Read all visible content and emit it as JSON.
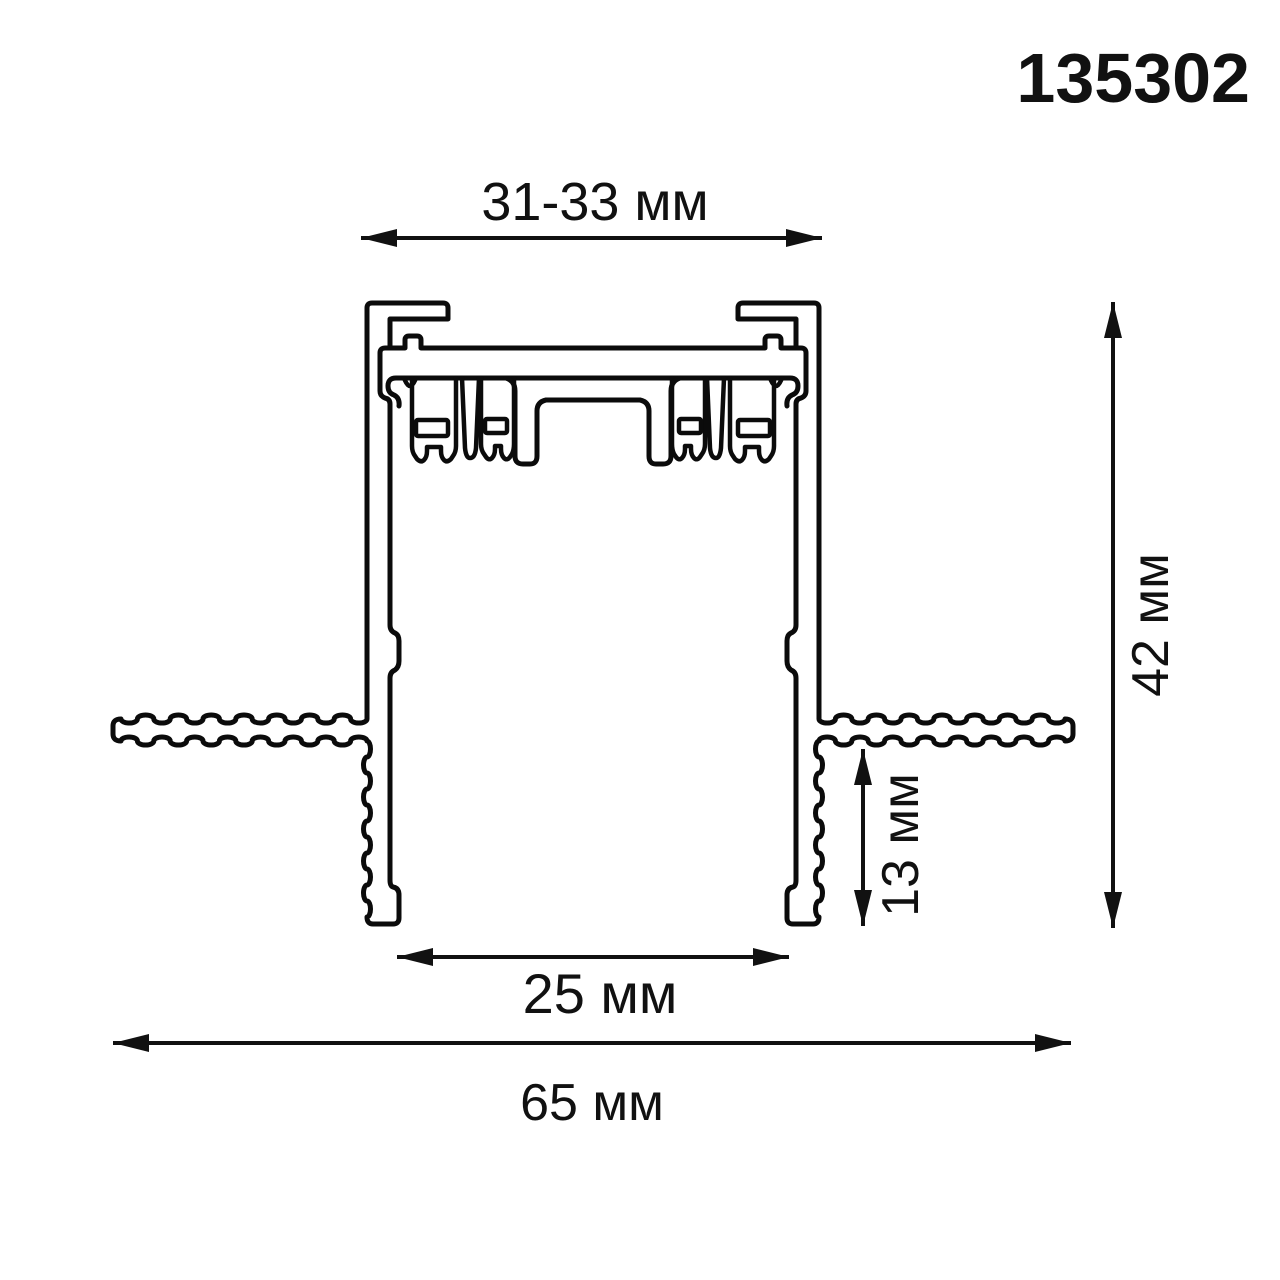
{
  "page": {
    "background": "#ffffff",
    "line_color": "#0b0b0b"
  },
  "product_code": "135302",
  "dimensions": {
    "top_width": {
      "label": "31-33 мм",
      "orientation": "horizontal"
    },
    "total_height": {
      "label": "42 мм",
      "orientation": "vertical"
    },
    "flange_height": {
      "label": "13 мм",
      "orientation": "vertical"
    },
    "opening_width": {
      "label": "25 мм",
      "orientation": "horizontal"
    },
    "total_width": {
      "label": "65 мм",
      "orientation": "horizontal"
    }
  }
}
